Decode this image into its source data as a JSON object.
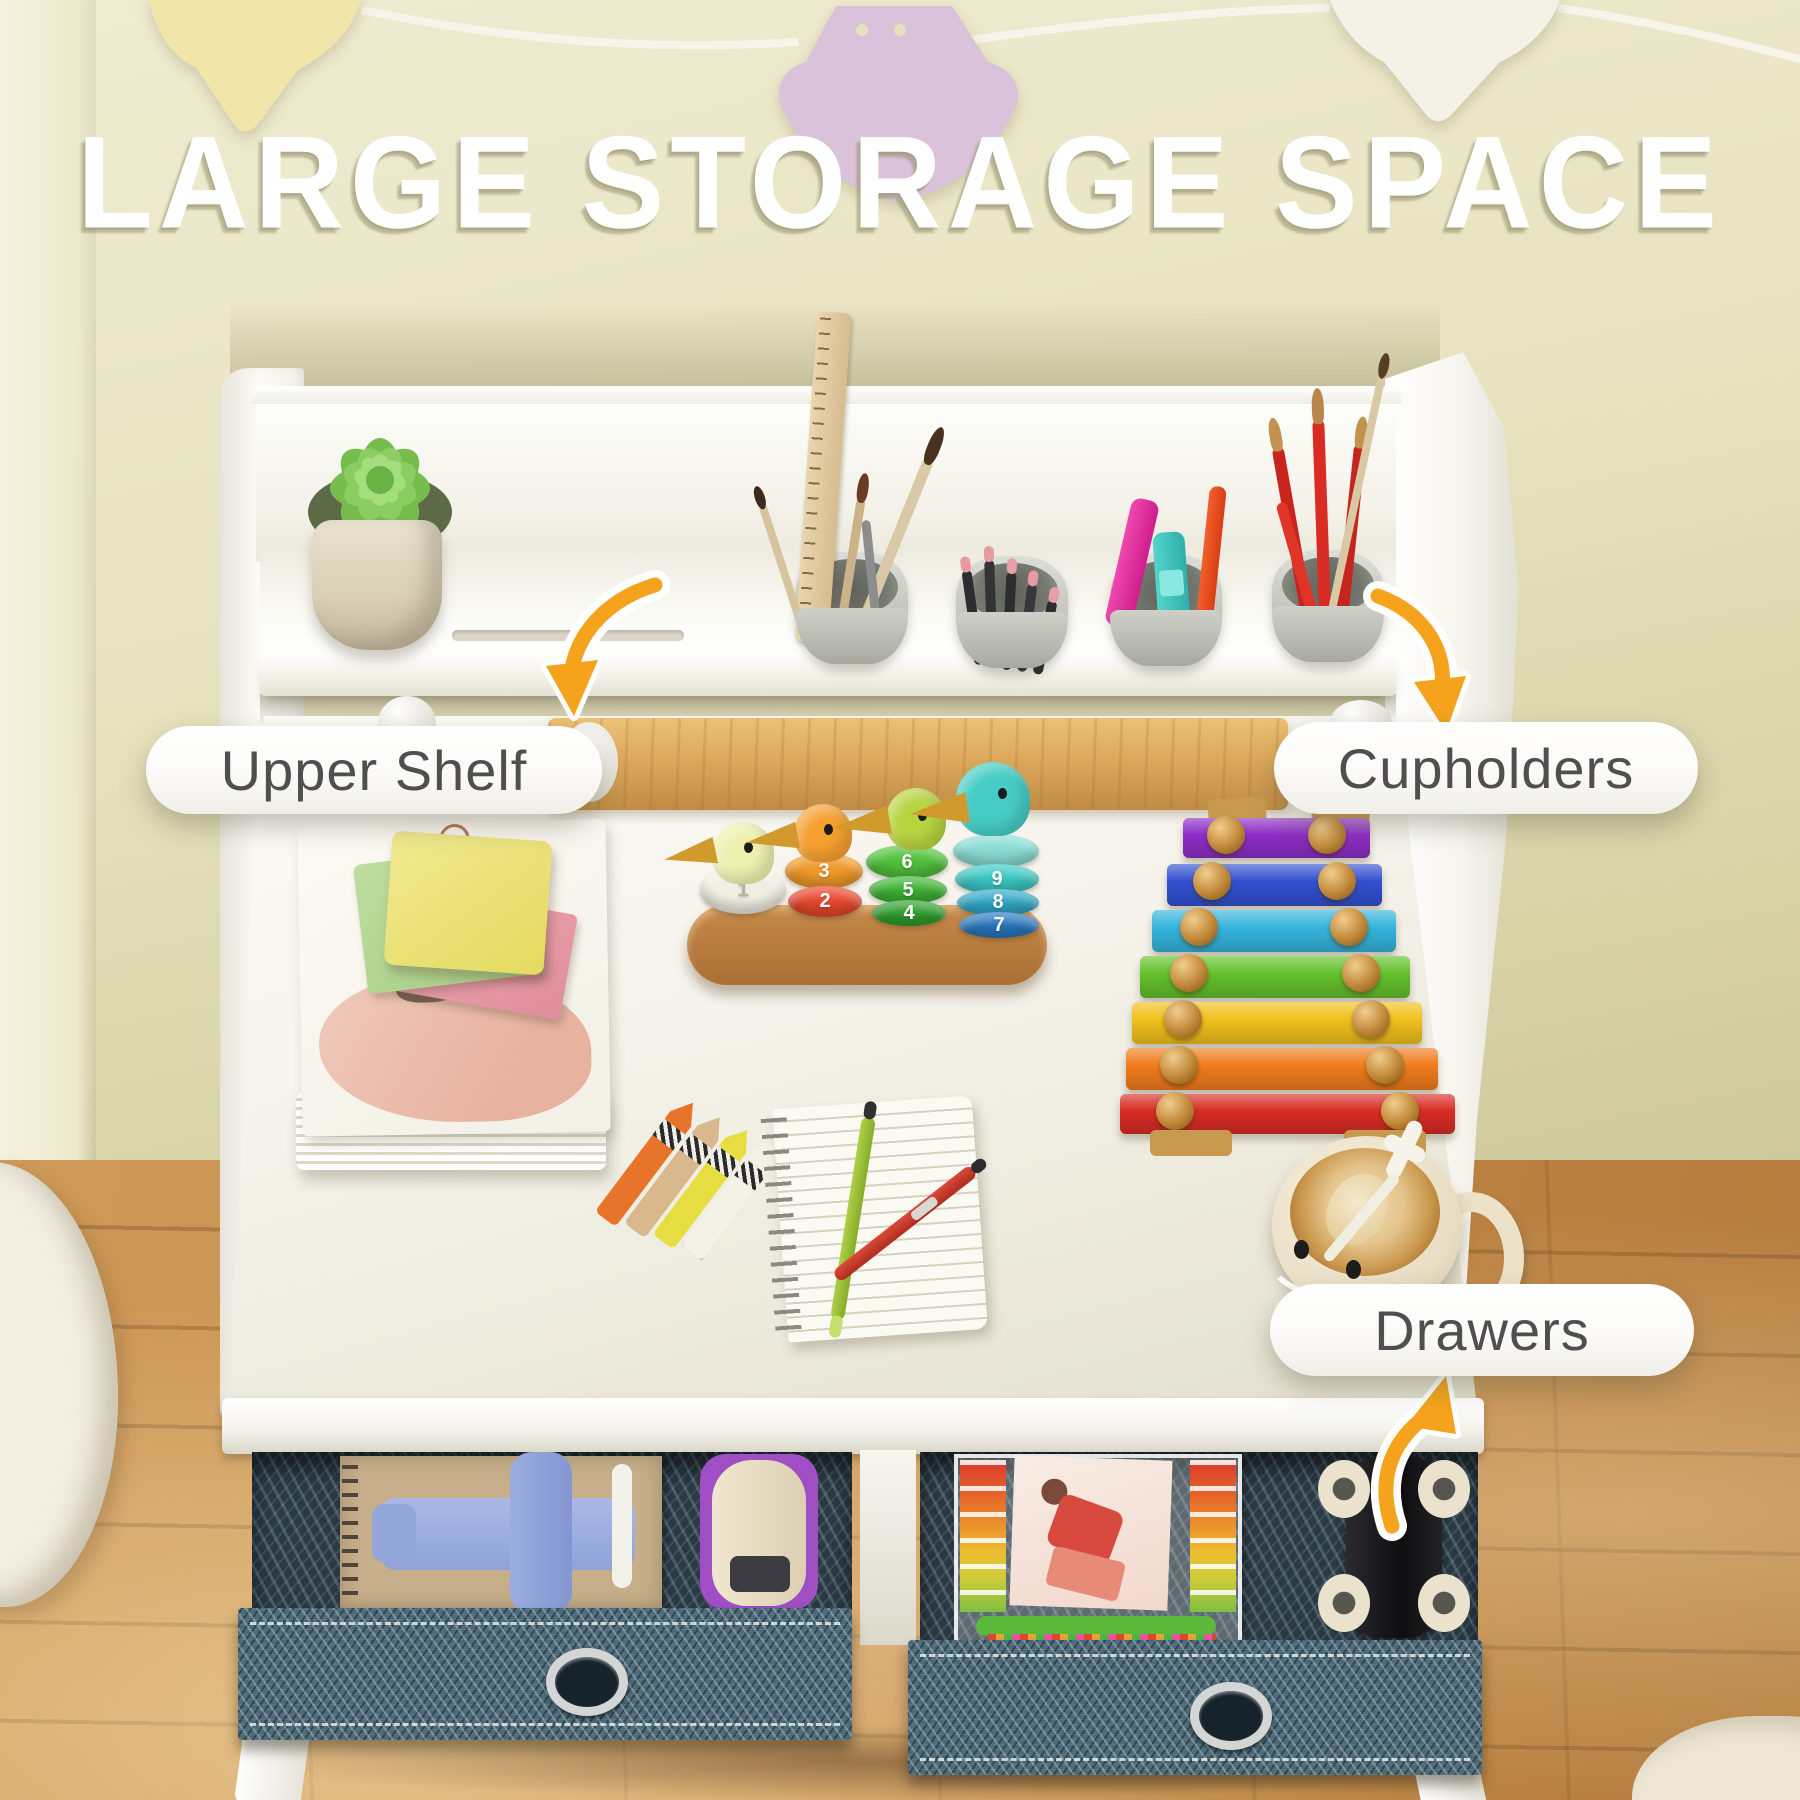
{
  "title": "LARGE STORAGE SPACE",
  "callouts": {
    "upper_shelf": {
      "label": "Upper Shelf"
    },
    "cupholders": {
      "label": "Cupholders"
    },
    "drawers": {
      "label": "Drawers"
    }
  },
  "duck_toy": {
    "ducks": [
      {
        "rings": [
          "1"
        ]
      },
      {
        "rings": [
          "3",
          "2"
        ]
      },
      {
        "rings": [
          "6",
          "5",
          "4"
        ]
      },
      {
        "rings": [
          "9",
          "8",
          "7"
        ]
      }
    ]
  },
  "colors": {
    "arrow_accent": "#f5a31d",
    "label_text": "#4f4f4f",
    "label_bg": "#ffffff",
    "title_text": "#ffffff",
    "wall": "#e4e0ba",
    "floor_wood": "#c08544",
    "desk_white": "#f7f6f0",
    "rail_wood": "#dca95b",
    "drawer_fabric": "#587482",
    "xylophone_bars": [
      "#8e2ec6",
      "#3150d0",
      "#34b4dc",
      "#64c02c",
      "#f0c01c",
      "#f07c1c",
      "#d82c24"
    ]
  }
}
